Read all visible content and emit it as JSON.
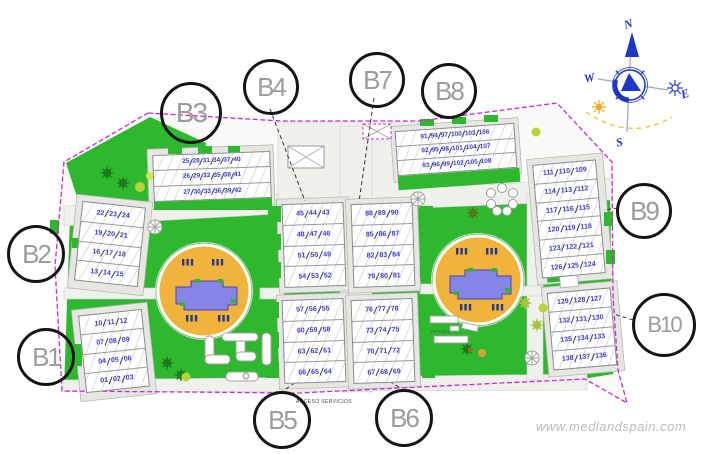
{
  "watermark": "www.medlandspain.com",
  "plan_labels": {
    "access": "ACCESO SERVICIOS",
    "petanque": "PETANCA"
  },
  "compass": {
    "north": "N",
    "south": "S",
    "east": "E",
    "west": "W"
  },
  "colors": {
    "boundary_magenta": "#cc2bcc",
    "grass_green": "#2eb82e",
    "pool_deck_orange": "#f2b33c",
    "pool_water_blue": "#8585e8",
    "unit_number_blue": "#3a3ad0",
    "compass_blue": "#1d35c8",
    "sun_orange": "#f5a81e",
    "label_gray": "#9c9c9c"
  },
  "block_labels": [
    {
      "id": "b1",
      "text": "B1"
    },
    {
      "id": "b2",
      "text": "B2"
    },
    {
      "id": "b3",
      "text": "B3"
    },
    {
      "id": "b4",
      "text": "B4"
    },
    {
      "id": "b5",
      "text": "B5"
    },
    {
      "id": "b6",
      "text": "B6"
    },
    {
      "id": "b7",
      "text": "B7"
    },
    {
      "id": "b8",
      "text": "B8"
    },
    {
      "id": "b9",
      "text": "B9"
    },
    {
      "id": "b10",
      "text": "B10"
    }
  ],
  "buildings": [
    {
      "id": "B1",
      "rows": [
        [
          "10",
          "11",
          "12"
        ],
        [
          "07",
          "08",
          "09"
        ],
        [
          "04",
          "05",
          "06"
        ],
        [
          "01",
          "02",
          "03"
        ]
      ]
    },
    {
      "id": "B2",
      "rows": [
        [
          "22",
          "23",
          "24"
        ],
        [
          "19",
          "20",
          "21"
        ],
        [
          "16",
          "17",
          "18"
        ],
        [
          "13",
          "14",
          "15"
        ]
      ]
    },
    {
      "id": "B3",
      "rows": [
        [
          "25",
          "28",
          "31",
          "34",
          "37",
          "40"
        ],
        [
          "26",
          "29",
          "32",
          "35",
          "38",
          "41"
        ],
        [
          "27",
          "30",
          "33",
          "36",
          "39",
          "42"
        ]
      ]
    },
    {
      "id": "B4",
      "rows": [
        [
          "45",
          "44",
          "43"
        ],
        [
          "48",
          "47",
          "46"
        ],
        [
          "51",
          "50",
          "49"
        ],
        [
          "54",
          "53",
          "52"
        ]
      ]
    },
    {
      "id": "B5",
      "rows": [
        [
          "57",
          "56",
          "55"
        ],
        [
          "60",
          "59",
          "58"
        ],
        [
          "63",
          "62",
          "61"
        ],
        [
          "66",
          "65",
          "64"
        ]
      ]
    },
    {
      "id": "B6",
      "rows": [
        [
          "76",
          "77",
          "78"
        ],
        [
          "73",
          "74",
          "75"
        ],
        [
          "70",
          "71",
          "72"
        ],
        [
          "67",
          "68",
          "69"
        ]
      ]
    },
    {
      "id": "B7",
      "rows": [
        [
          "88",
          "89",
          "90"
        ],
        [
          "85",
          "86",
          "87"
        ],
        [
          "82",
          "83",
          "84"
        ],
        [
          "79",
          "80",
          "81"
        ]
      ]
    },
    {
      "id": "B8",
      "rows": [
        [
          "91",
          "94",
          "97",
          "100",
          "103",
          "106"
        ],
        [
          "92",
          "95",
          "98",
          "101",
          "104",
          "107"
        ],
        [
          "93",
          "96",
          "99",
          "102",
          "105",
          "108"
        ]
      ]
    },
    {
      "id": "B9",
      "rows": [
        [
          "111",
          "110",
          "109"
        ],
        [
          "114",
          "113",
          "112"
        ],
        [
          "117",
          "116",
          "115"
        ],
        [
          "120",
          "119",
          "118"
        ],
        [
          "123",
          "122",
          "121"
        ],
        [
          "126",
          "125",
          "124"
        ]
      ]
    },
    {
      "id": "B10",
      "rows": [
        [
          "129",
          "128",
          "127"
        ],
        [
          "132",
          "131",
          "130"
        ],
        [
          "135",
          "134",
          "133"
        ],
        [
          "138",
          "137",
          "136"
        ]
      ]
    }
  ]
}
